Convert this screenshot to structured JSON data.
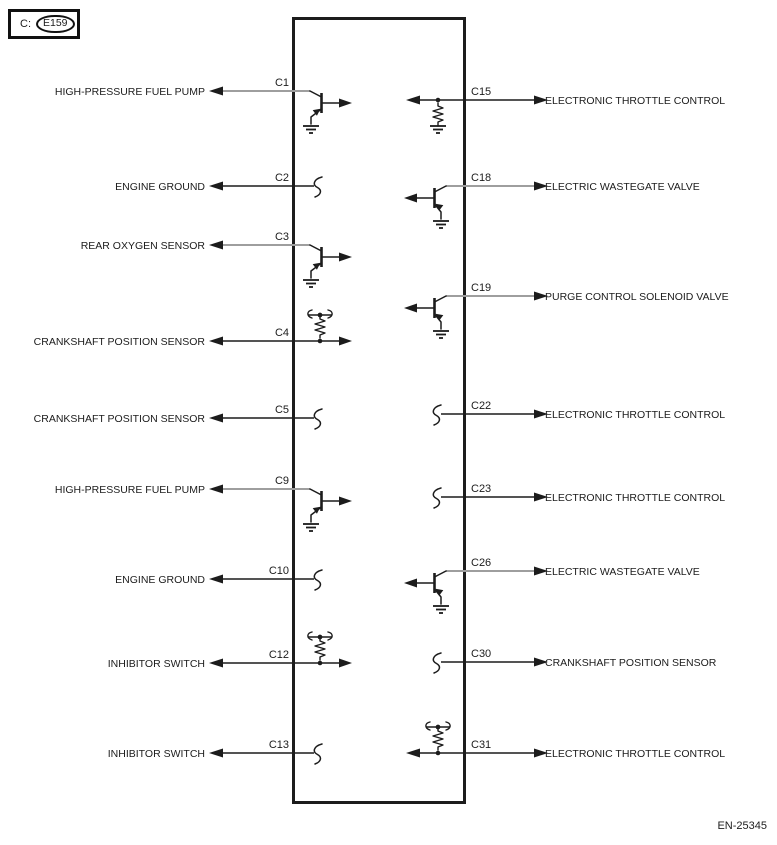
{
  "header": {
    "prefix_label": "C:",
    "connector_id": "E159"
  },
  "footer": {
    "doc_code": "EN-25345"
  },
  "colors": {
    "line": "#1c1c1c",
    "wire_gray": "#9e9e9e",
    "text": "#1c1c1c"
  },
  "ecm_box": {
    "x": 293.5,
    "y": 18.5,
    "width": 171,
    "height": 784
  },
  "rows": {
    "left": [
      {
        "pin": "C1",
        "label": "HIGH-PRESSURE FUEL PUMP",
        "y": 91,
        "symbol": "transistor",
        "wire": "gray"
      },
      {
        "pin": "C2",
        "label": "ENGINE GROUND",
        "y": 186,
        "symbol": "open",
        "wire": "black"
      },
      {
        "pin": "C3",
        "label": "REAR OXYGEN SENSOR",
        "y": 245,
        "symbol": "transistor",
        "wire": "gray"
      },
      {
        "pin": "C4",
        "label": "CRANKSHAFT POSITION SENSOR",
        "y": 341,
        "symbol": "resistor_pullup",
        "wire": "black"
      },
      {
        "pin": "C5",
        "label": "CRANKSHAFT POSITION SENSOR",
        "y": 418,
        "symbol": "open",
        "wire": "black"
      },
      {
        "pin": "C9",
        "label": "HIGH-PRESSURE FUEL PUMP",
        "y": 489,
        "symbol": "transistor",
        "wire": "gray"
      },
      {
        "pin": "C10",
        "label": "ENGINE GROUND",
        "y": 579,
        "symbol": "open",
        "wire": "black"
      },
      {
        "pin": "C12",
        "label": "INHIBITOR SWITCH",
        "y": 663,
        "symbol": "resistor_pullup",
        "wire": "black"
      },
      {
        "pin": "C13",
        "label": "INHIBITOR SWITCH",
        "y": 753,
        "symbol": "open",
        "wire": "black"
      }
    ],
    "right": [
      {
        "pin": "C15",
        "label": "ELECTRONIC THROTTLE CONTROL",
        "y": 100,
        "symbol": "resistor_ground",
        "wire": "black"
      },
      {
        "pin": "C18",
        "label": "ELECTRIC WASTEGATE VALVE",
        "y": 186,
        "symbol": "transistor",
        "wire": "gray"
      },
      {
        "pin": "C19",
        "label": "PURGE CONTROL SOLENOID VALVE",
        "y": 296,
        "symbol": "transistor",
        "wire": "gray"
      },
      {
        "pin": "C22",
        "label": "ELECTRONIC THROTTLE CONTROL",
        "y": 414,
        "symbol": "open",
        "wire": "black"
      },
      {
        "pin": "C23",
        "label": "ELECTRONIC THROTTLE CONTROL",
        "y": 497,
        "symbol": "open",
        "wire": "black"
      },
      {
        "pin": "C26",
        "label": "ELECTRIC WASTEGATE VALVE",
        "y": 571,
        "symbol": "transistor",
        "wire": "gray"
      },
      {
        "pin": "C30",
        "label": "CRANKSHAFT POSITION SENSOR",
        "y": 662,
        "symbol": "open",
        "wire": "black"
      },
      {
        "pin": "C31",
        "label": "ELECTRONIC THROTTLE CONTROL",
        "y": 753,
        "symbol": "resistor_pullup",
        "wire": "black"
      }
    ]
  }
}
